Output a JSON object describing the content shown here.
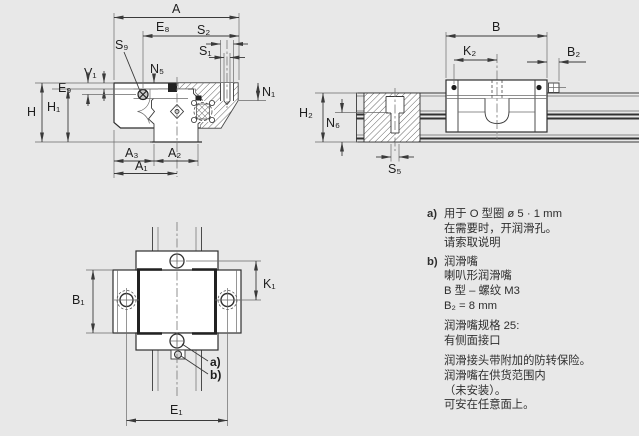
{
  "background": "#e8e8e8",
  "line_color": "#2f2f2f",
  "views": {
    "cross_section": {
      "name": "runner block cross section",
      "labels": {
        "A": "A",
        "E8": "E₈",
        "S2": "S₂",
        "S1": "S₁",
        "S9": "S₉",
        "V1": "V₁",
        "N5": "N₅",
        "N1": "N₁",
        "E9": "E₉",
        "H": "H",
        "H1": "H₁",
        "A3": "A₃",
        "A2": "A₂",
        "A1": "A₁"
      }
    },
    "side_view": {
      "name": "carriage on rail side view",
      "labels": {
        "B": "B",
        "K2": "K₂",
        "B2": "B₂",
        "H2": "H₂",
        "N6": "N₆",
        "S5": "S₅"
      }
    },
    "top_view": {
      "name": "carriage top view",
      "labels": {
        "B1": "B₁",
        "K1": "K₁",
        "E1": "E₁",
        "a": "a)",
        "b": "b)"
      }
    }
  },
  "notes": {
    "a": {
      "marker": "a)",
      "lines": [
        "用于 O 型圈 ø 5 · 1 mm",
        "在需要时，开润滑孔。",
        "请索取说明"
      ]
    },
    "b": {
      "marker": "b)",
      "lines": [
        "润滑嘴",
        "喇叭形润滑嘴",
        "B 型 – 螺纹 M3",
        "B₂ = 8 mm"
      ]
    },
    "spec": {
      "lines": [
        "润滑嘴规格 25:",
        "有侧面接口"
      ]
    },
    "info": {
      "lines": [
        "润滑接头带附加的防转保险。",
        "润滑嘴在供货范围内",
        "（未安装）。",
        "可安在任意面上。"
      ]
    }
  }
}
